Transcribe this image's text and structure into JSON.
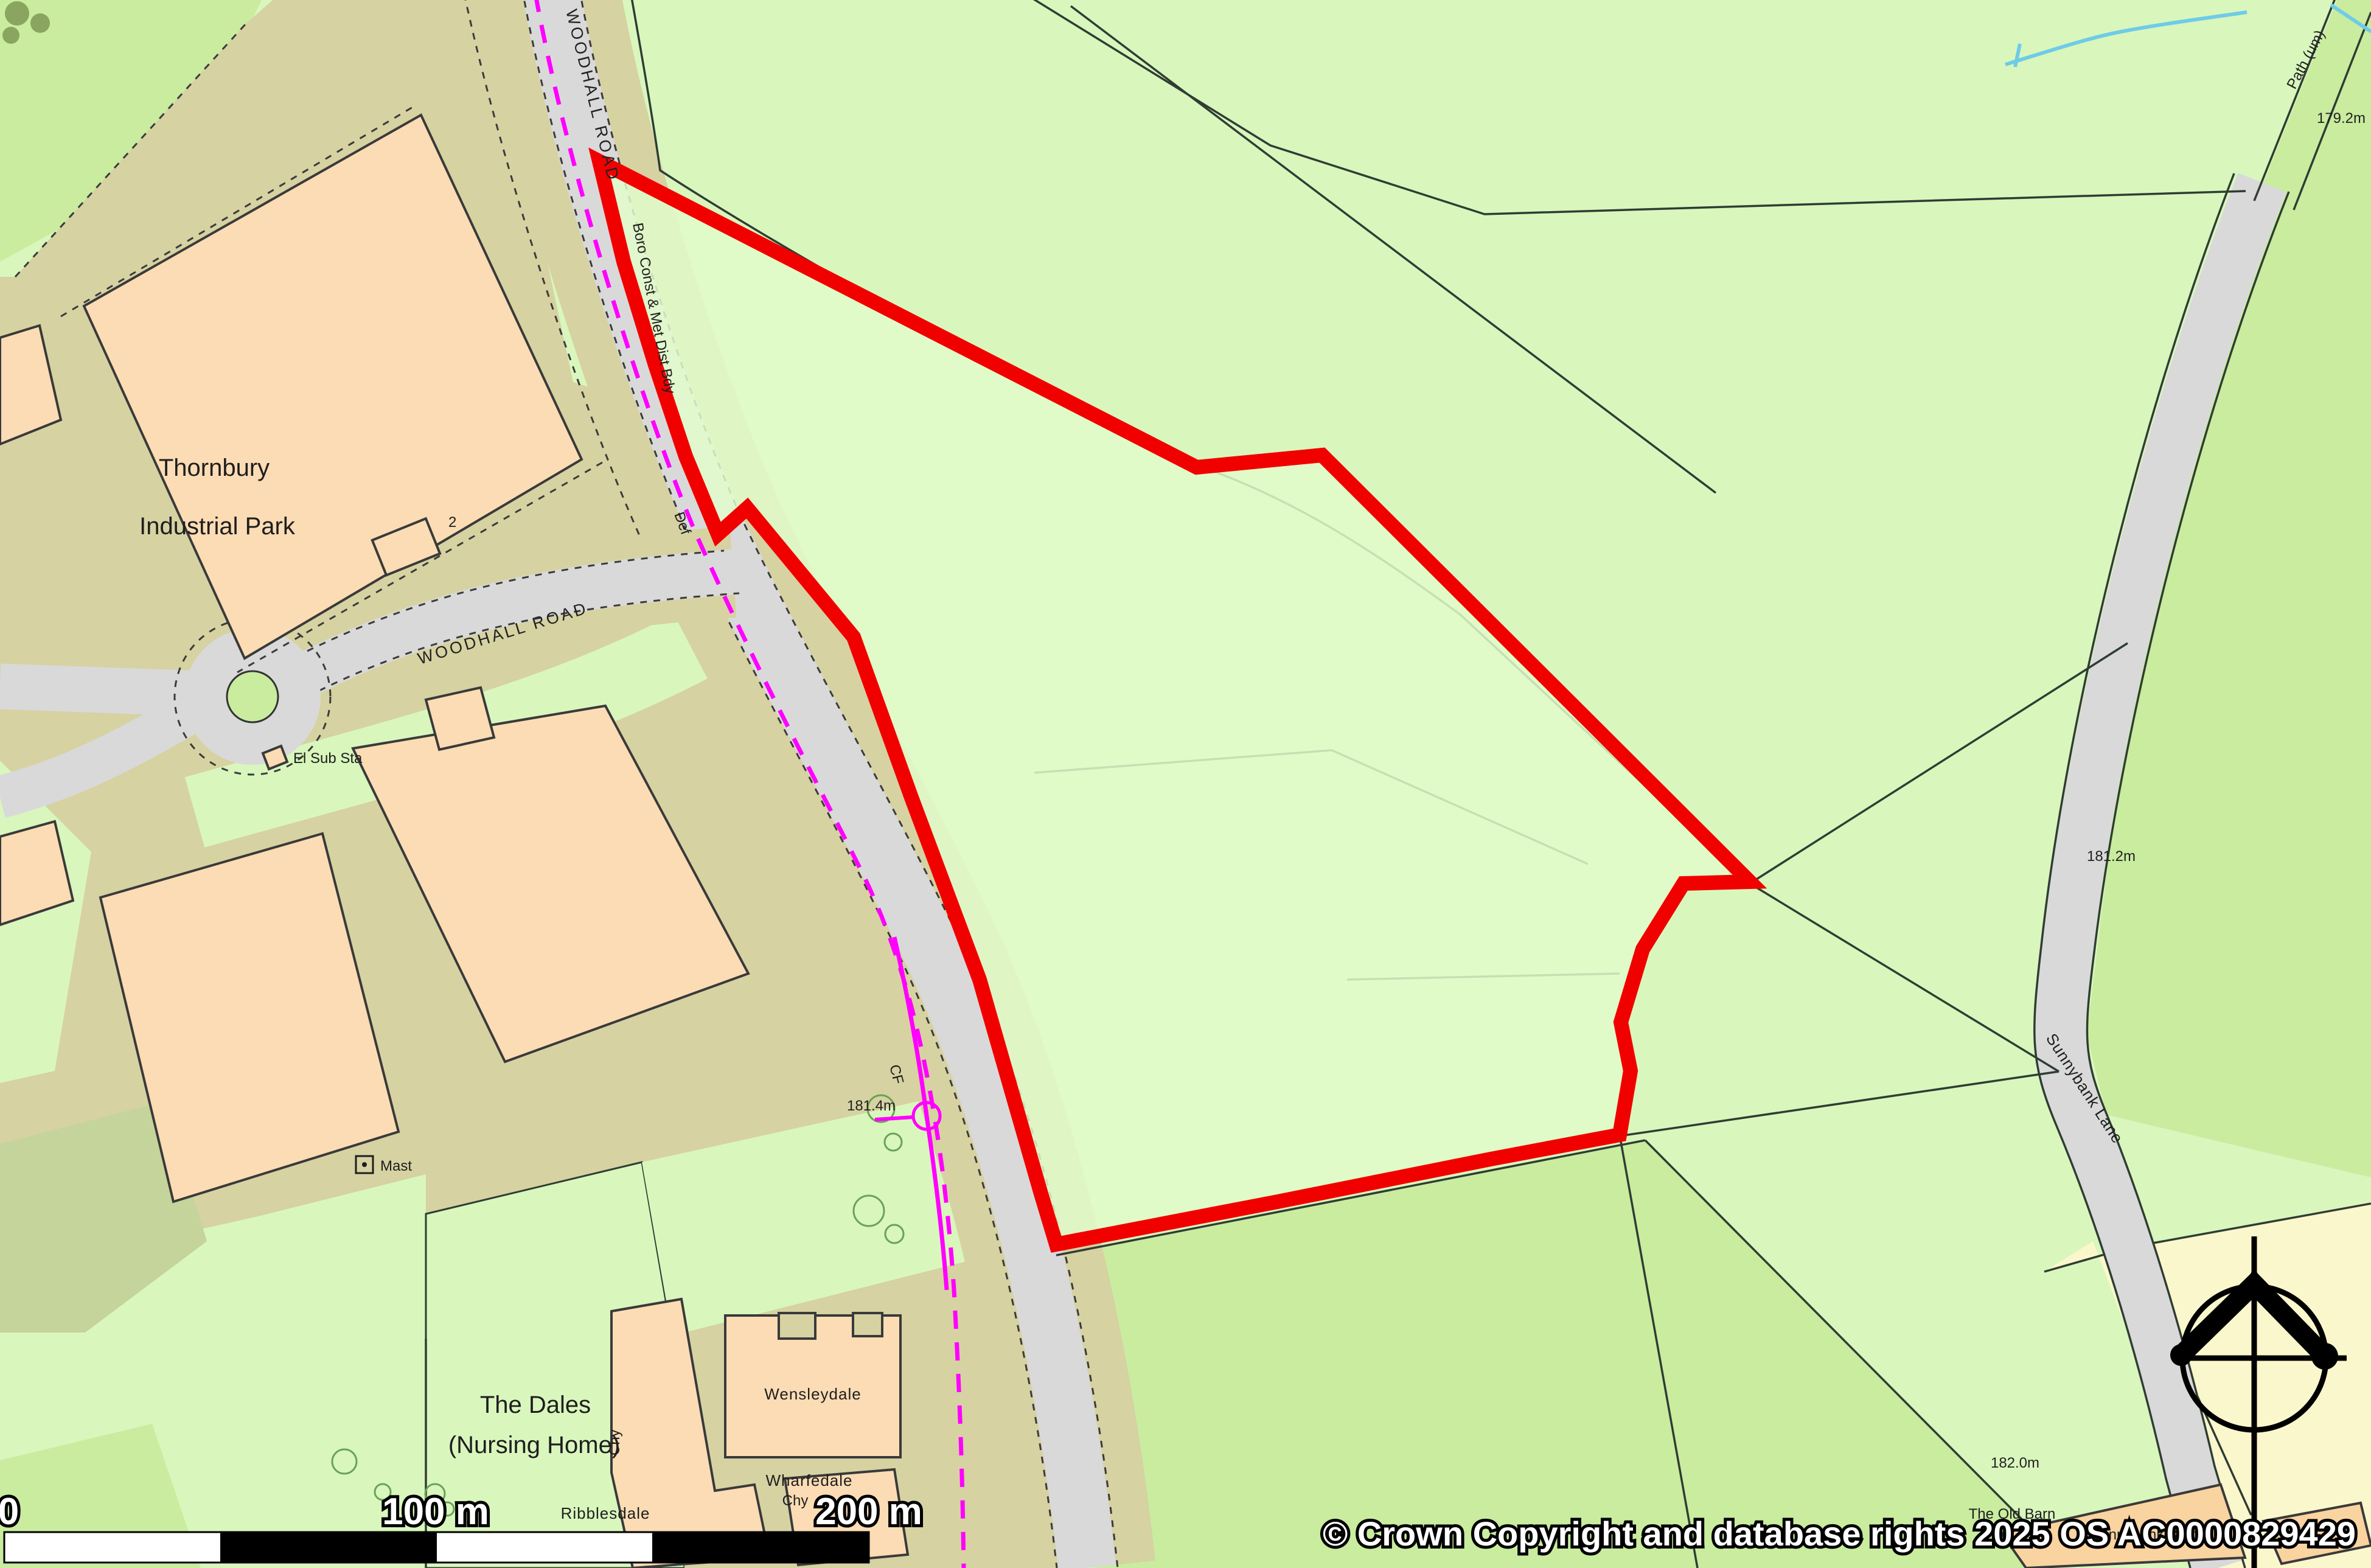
{
  "map": {
    "type": "ordnance-survey-site-plan",
    "labels": {
      "road_top": "WOODHALL ROAD",
      "road_curved": "WOODHALL ROAD",
      "admin_boundary": "Boro Const & Met Dist Bdy",
      "industrial_park_line1": "Thornbury",
      "industrial_park_line2": "Industrial Park",
      "el_sub_sta": "El Sub Sta",
      "nursing_home_line1": "The Dales",
      "nursing_home_line2": "(Nursing Home)",
      "wensleydale": "Wensleydale",
      "ribblesdale": "Ribblesdale",
      "wharfedale": "Wharfedale",
      "chy_1": "Chy",
      "chy_2": "Chy",
      "mast": "Mast",
      "def_marker": "Def",
      "cf_marker": "CF",
      "path_um": "Path (um)",
      "sunnybank_lane": "Sunnybank Lane",
      "old_barn": "The Old Barn",
      "sunnybank_barn": "Sunnybank Barn",
      "building_number": "2",
      "spot_height_1": "179.2m",
      "spot_height_2": "181.2m",
      "spot_height_3": "181.4m",
      "spot_height_4": "182.0m"
    },
    "scalebar": {
      "zero": "0",
      "mid": "100 m",
      "end": "200 m"
    },
    "copyright": "© Crown Copyright and database rights 2025 OS AC0000829429",
    "colors": {
      "site_boundary_red": "#f10000",
      "field_light_green": "#d9f6bd",
      "field_medium_green": "#c9ec9f",
      "site_interior_green": "#e2fbca",
      "industrial_khaki": "#d6d2a2",
      "building_peach": "#fbdcb4",
      "road_gray": "#d9d9d9",
      "parcel_yellow": "#fbf7cc",
      "admin_boundary_magenta": "#ff00ff",
      "water_blue": "#6fcbe8",
      "olive_patch": "#c5d49b"
    }
  }
}
